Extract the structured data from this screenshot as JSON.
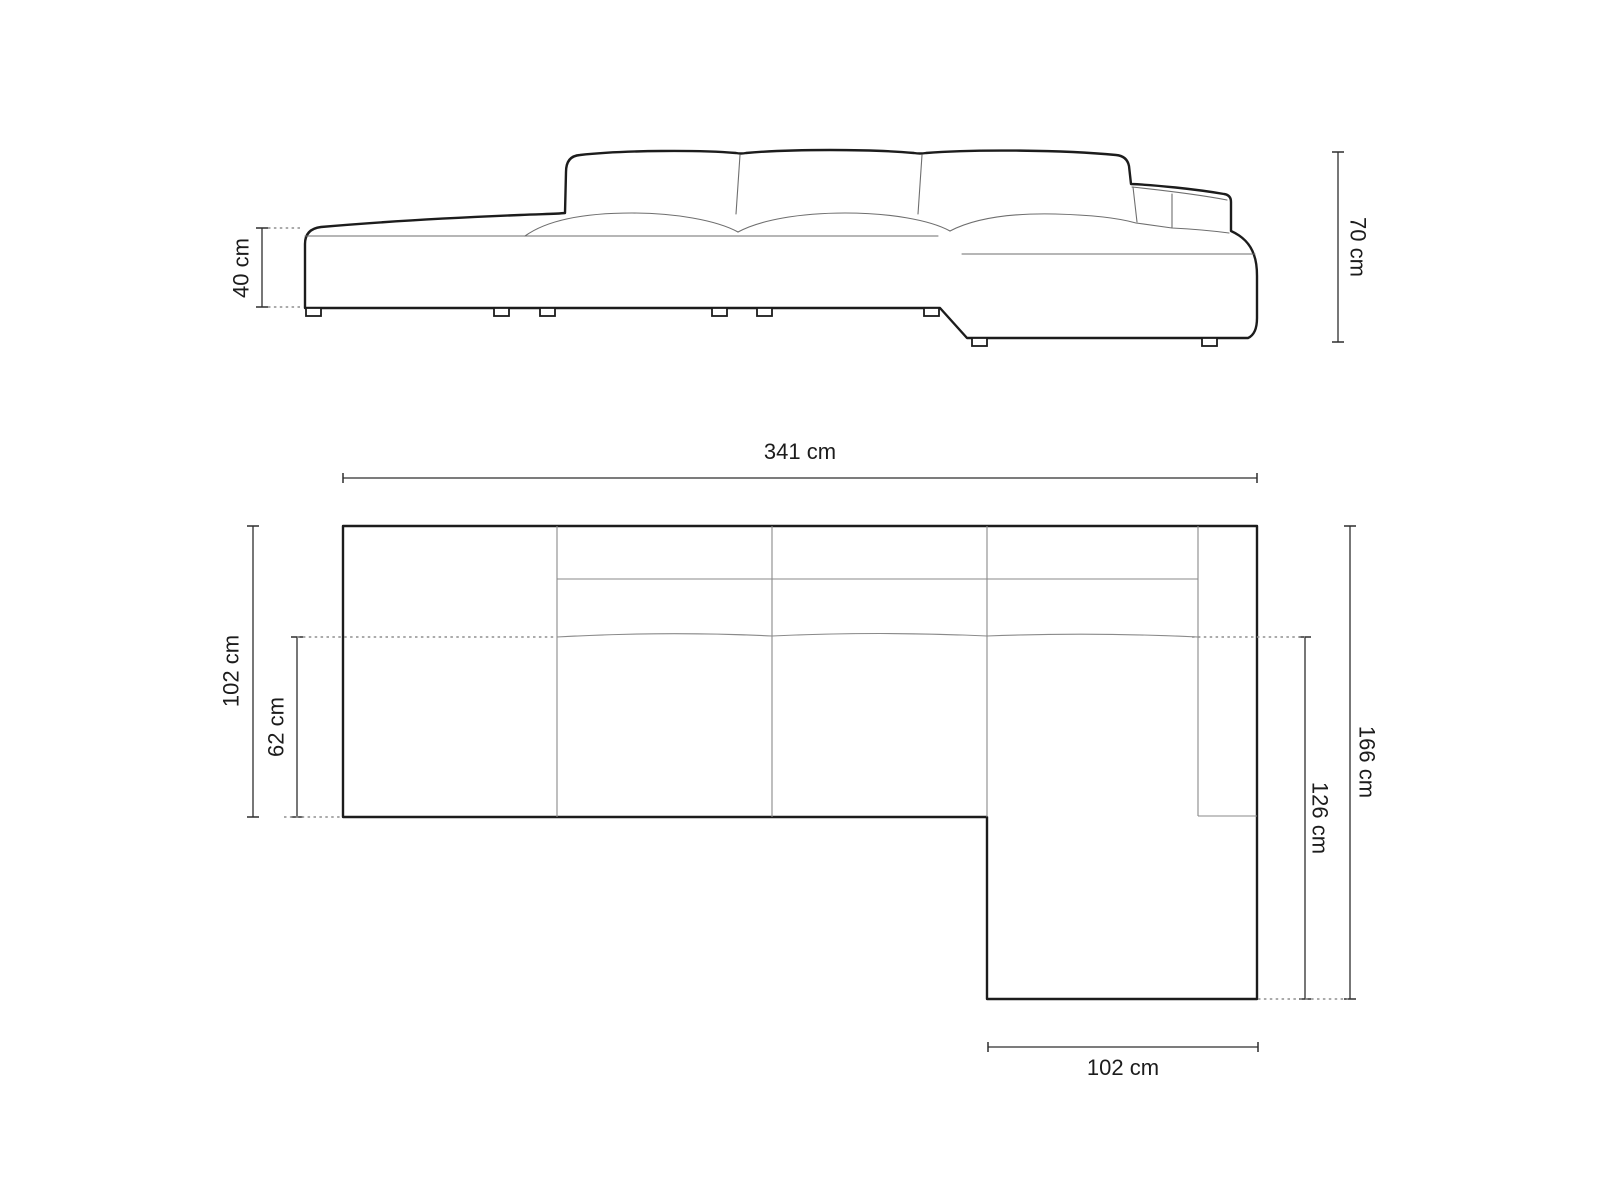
{
  "figure": {
    "type": "sofa-dimension-diagram",
    "unit": "cm"
  },
  "side_view": {
    "seat_height": {
      "label": "40 cm",
      "value": 40
    },
    "total_height": {
      "label": "70 cm",
      "value": 70
    }
  },
  "top_view": {
    "total_width": {
      "label": "341 cm",
      "value": 341
    },
    "left_depth": {
      "label": "102 cm",
      "value": 102
    },
    "seat_depth": {
      "label": "62 cm",
      "value": 62
    },
    "total_depth": {
      "label": "166 cm",
      "value": 166
    },
    "chaise_depth": {
      "label": "126 cm",
      "value": 126
    },
    "chaise_width": {
      "label": "102 cm",
      "value": 102
    }
  }
}
